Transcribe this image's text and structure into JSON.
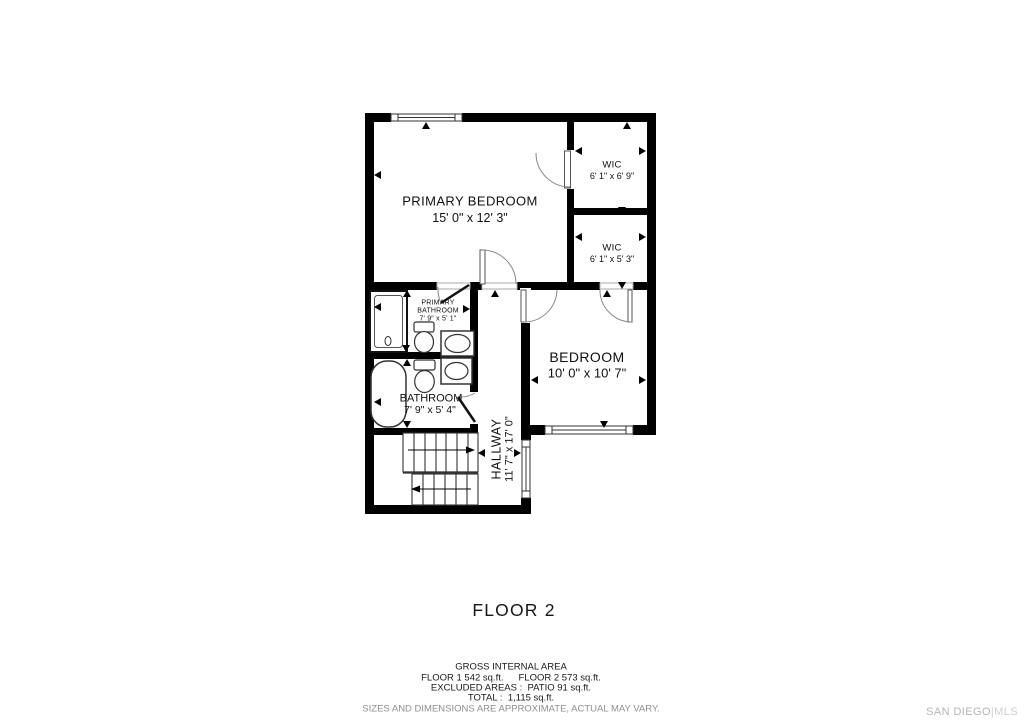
{
  "plan": {
    "floor_label": "FLOOR 2",
    "rooms": {
      "primary_bedroom": {
        "name": "PRIMARY BEDROOM",
        "dims": "15' 0\" x 12' 3\""
      },
      "wic_top": {
        "name": "WIC",
        "dims": "6' 1\" x 6' 9\""
      },
      "wic_bottom": {
        "name": "WIC",
        "dims": "6' 1\" x 5' 3\""
      },
      "primary_bathroom": {
        "name_line1": "PRIMARY",
        "name_line2": "BATHROOM",
        "dims": "7' 9\" x 5' 1\""
      },
      "bathroom": {
        "name": "BATHROOM",
        "dims": "7' 9\" x 5' 4\""
      },
      "hallway": {
        "name": "HALLWAY",
        "dims": "11' 7\" x 17' 0\""
      },
      "bedroom": {
        "name": "BEDROOM",
        "dims": "10' 0\" x 10' 7\""
      }
    }
  },
  "summary": {
    "heading": "GROSS INTERNAL AREA",
    "floor1": "FLOOR 1 542 sq.ft.",
    "floor2": "FLOOR 2 573 sq.ft.",
    "excluded": "EXCLUDED AREAS :  PATIO 91 sq.ft.",
    "total": "TOTAL :  1,115 sq.ft.",
    "disclaimer": "SIZES AND DIMENSIONS ARE APPROXIMATE, ACTUAL MAY VARY."
  },
  "branding": {
    "name": "SAN DIEGO",
    "divider": "|",
    "suffix": "MLS"
  }
}
